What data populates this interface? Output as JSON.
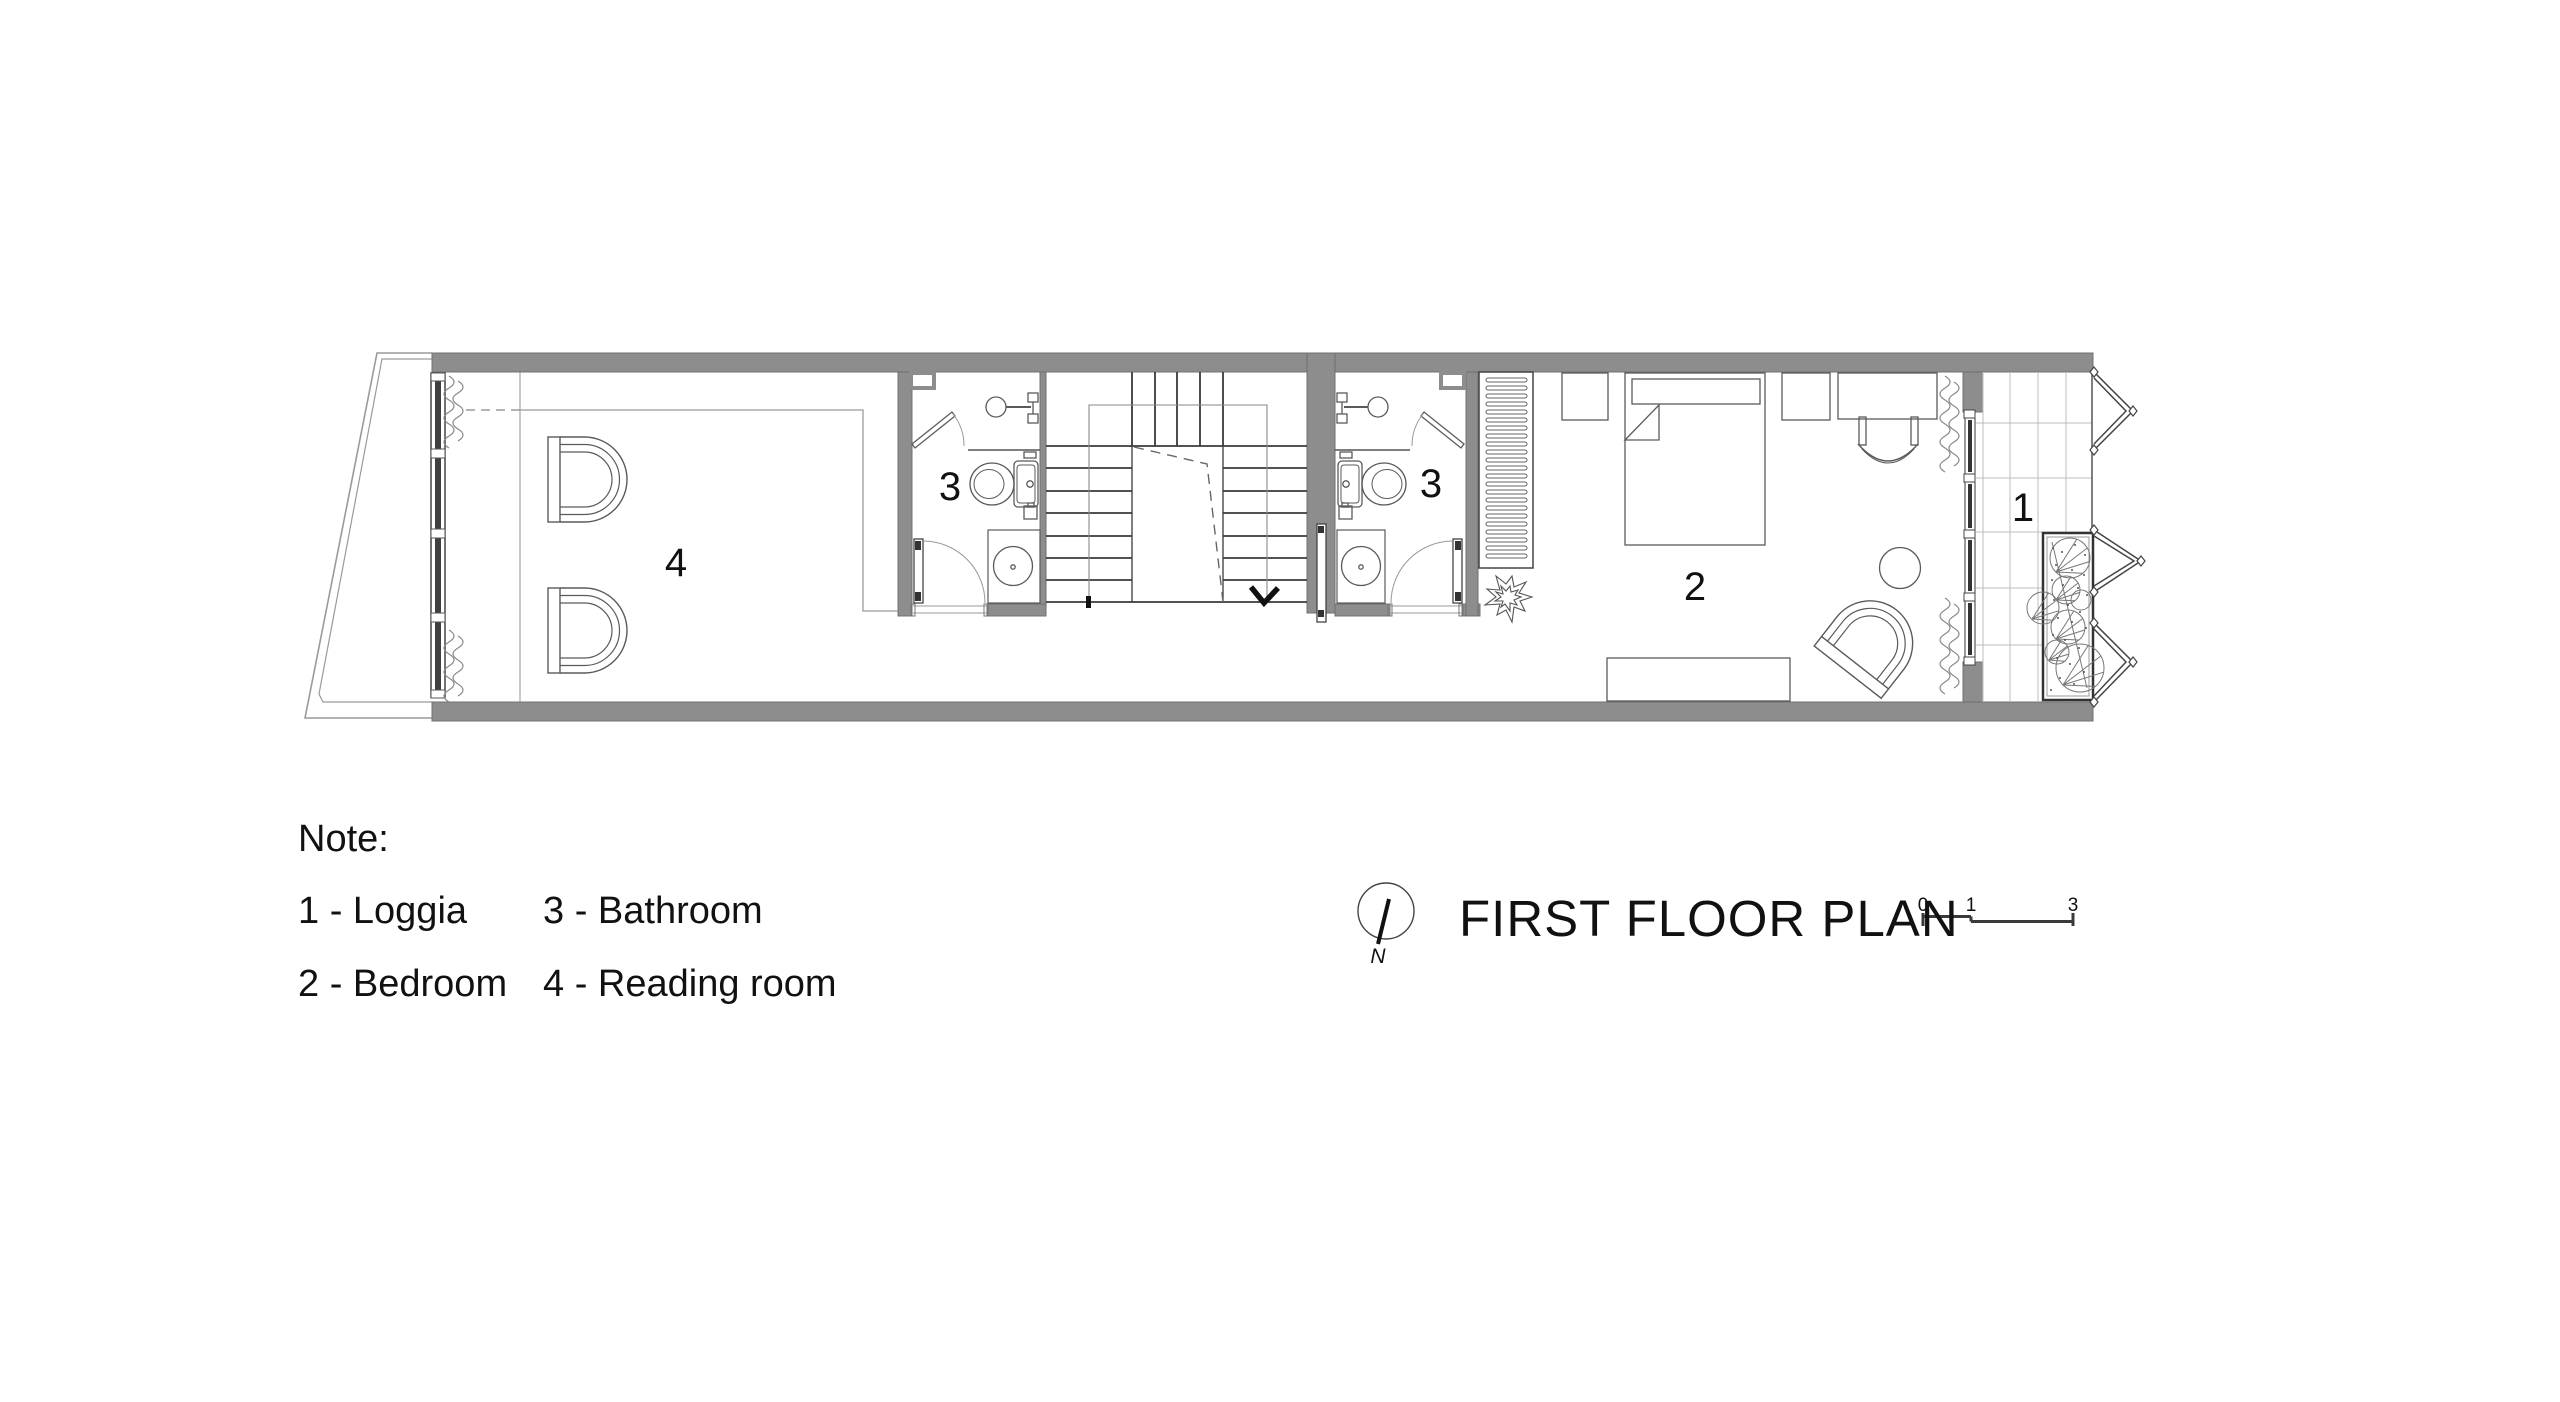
{
  "header": {
    "title": "FIRST FLOOR PLAN"
  },
  "north": {
    "label": "N"
  },
  "scale_bar": {
    "ticks": [
      "0",
      "1",
      "3"
    ]
  },
  "rooms": {
    "loggia": "1",
    "bedroom": "2",
    "bathroom_left": "3",
    "bathroom_right": "3",
    "reading_room": "4"
  },
  "note": {
    "heading": "Note:",
    "items": [
      {
        "text": "1 - Loggia"
      },
      {
        "text": "2 - Bedroom"
      },
      {
        "text": "3 - Bathroom"
      },
      {
        "text": "4 - Reading room"
      }
    ]
  },
  "colors": {
    "wall": "#8d8d8d",
    "wall_edge": "#707070",
    "line": "#3f3f3f",
    "furniture": "#5a5a5a",
    "guide": "#9a9a9a",
    "tile": "#bcbcbc",
    "text": "#111111"
  }
}
